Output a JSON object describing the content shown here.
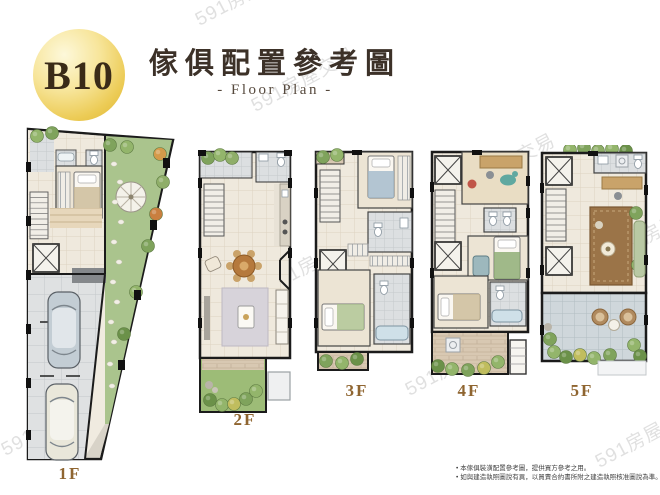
{
  "badge": {
    "label": "B10"
  },
  "header": {
    "title": "傢俱配置參考圖",
    "subtitle": "- Floor Plan -"
  },
  "floors": [
    {
      "label": "1F"
    },
    {
      "label": "2F"
    },
    {
      "label": "3F"
    },
    {
      "label": "4F"
    },
    {
      "label": "5F"
    }
  ],
  "notes": {
    "items": [
      "本傢俱裝潢配置參考圖，提供買方參考之用。",
      "如與建造執照圖說有異，以買賣合約書所附之建造執照核准圖說為準。"
    ]
  },
  "watermark": {
    "text": "591房屋交易"
  },
  "colors": {
    "badge_gold": "#eccb55",
    "title_brown": "#3c3128",
    "floor_label_brown": "#8f6530",
    "garden_green": "#aac48d",
    "wall_black": "#1b1b1b"
  }
}
